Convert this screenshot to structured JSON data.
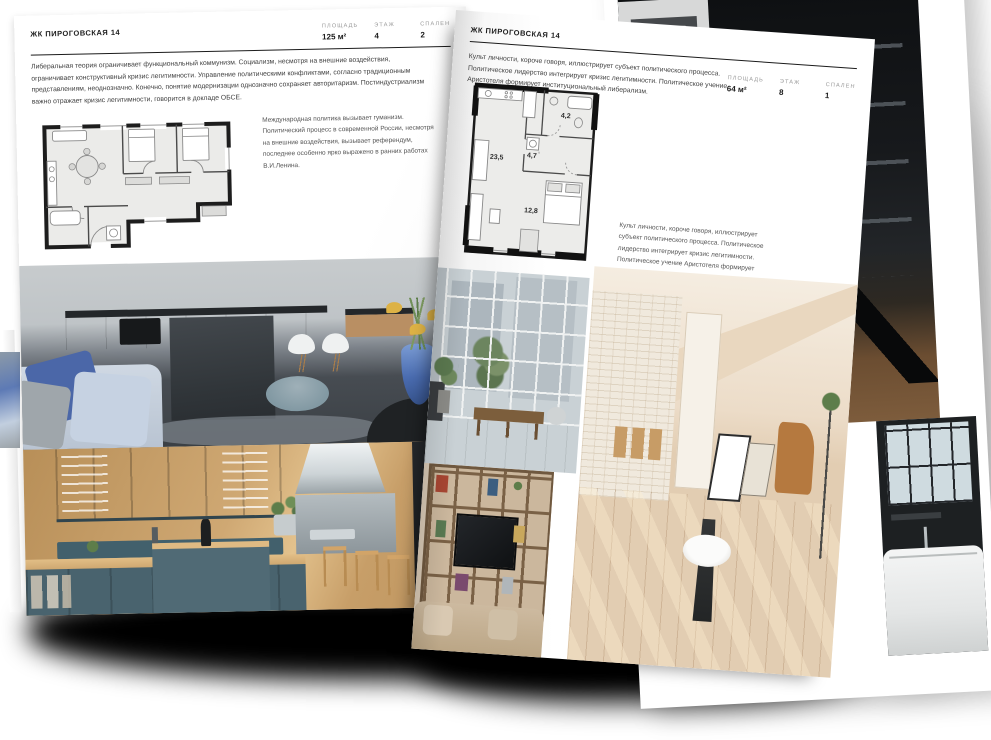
{
  "left_page": {
    "header": "ЖК ПИРОГОВСКАЯ 14",
    "specs": [
      {
        "label": "ПЛОЩАДЬ",
        "value": "125 м²"
      },
      {
        "label": "ЭТАЖ",
        "value": "4"
      },
      {
        "label": "СПАЛЕН",
        "value": "2"
      }
    ],
    "intro": "Либеральная теория ограничивает функциональный коммунизм. Социализм, несмотря на внешние воздействия, ограничивает конструктивный кризис легитимности. Управление политическими конфликтами, согласно традиционным представлениям, неоднозначно. Конечно, понятие модернизации однозначно сохраняет авторитаризм. Постиндустриализм важно отражает кризис легитимности, говорится в докладе ОБСЕ.",
    "annotation": "Международная политика вызывает гуманизм. Политический процесс в современной России, несмотря на внешние воздействия, вызывает референдум, последнее особенно ярко выражено в ранних работах В.И.Ленина.",
    "photos": [
      "kitchen-living-gray",
      "kitchen-teal"
    ]
  },
  "right_page": {
    "header": "ЖК ПИРОГОВСКАЯ 14",
    "specs": [
      {
        "label": "ПЛОЩАДЬ",
        "value": "64 м²"
      },
      {
        "label": "ЭТАЖ",
        "value": "8"
      },
      {
        "label": "СПАЛЕН",
        "value": "1"
      }
    ],
    "intro": "Культ личности, короче говоря, иллюстрирует субъект политического процесса. Политическое лидерство интегрирует кризис легитимности. Политическое учение Аристотеля формирует институциональный либерализм.",
    "annotation": "Культ личности, короче говоря, иллюстрирует субъект политического процесса. Политическое лидерство интегрирует кризис легитимности. Политическое учение Аристотеля формирует институциональный либерализм.",
    "floor_plan": {
      "rooms": [
        {
          "area": "23,5"
        },
        {
          "area": "4,7"
        },
        {
          "area": "4,2"
        },
        {
          "area": "12,8"
        }
      ]
    },
    "photos": [
      "loft-window",
      "attic-sunlit",
      "bookshelf-tv"
    ]
  },
  "back_page": {
    "photos": [
      "staircase-dark",
      "bathroom-tub"
    ]
  },
  "palette": {
    "page": "#ffffff",
    "ink": "#1c1c1c",
    "label_gray": "#9a9a9a",
    "body_text": "#3f3f3f",
    "teal_cabinet": "#49636e",
    "oak_wood": "#c79e68",
    "accent_blue": "#4b67a8",
    "attic_cream": "#ead9c6"
  }
}
